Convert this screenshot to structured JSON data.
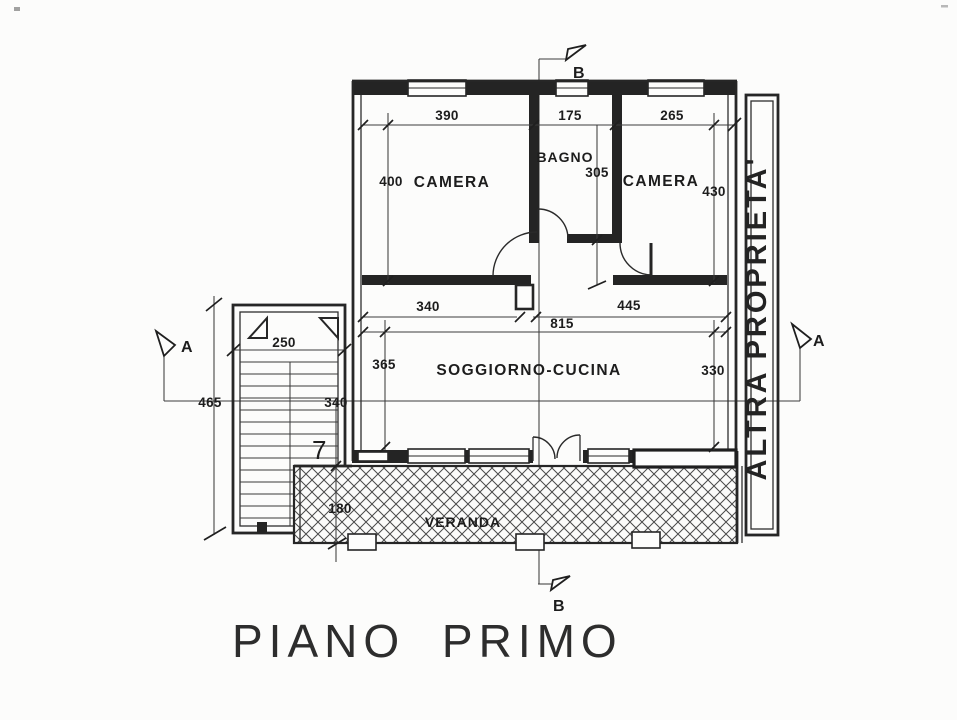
{
  "title": "PIANO PRIMO",
  "rooms": {
    "camera_left": "CAMERA",
    "bagno": "BAGNO",
    "camera_right": "CAMERA",
    "soggiorno_cucina": "SOGGIORNO-CUCINA",
    "veranda": "VERANDA",
    "altra_proprieta": "ALTRA PROPRIETA'"
  },
  "dimensions": {
    "camera_left_width": "390",
    "bagno_width": "175",
    "camera_right_width": "265",
    "camera_left_depth": "400",
    "bagno_depth": "305",
    "camera_right_depth": "430",
    "soggiorno_left_width": "340",
    "soggiorno_right_width": "445",
    "soggiorno_total_width": "815",
    "soggiorno_left_depth": "365",
    "soggiorno_right_depth": "330",
    "stair_width": "250",
    "stair_length": "465",
    "landing_width": "340",
    "veranda_depth": "180",
    "stair_note": "7"
  },
  "section_markers": {
    "a": "A",
    "b": "B"
  },
  "colors": {
    "ink": "#262626",
    "paper": "#fcfcfb",
    "hatch": "#4a4a4a"
  }
}
